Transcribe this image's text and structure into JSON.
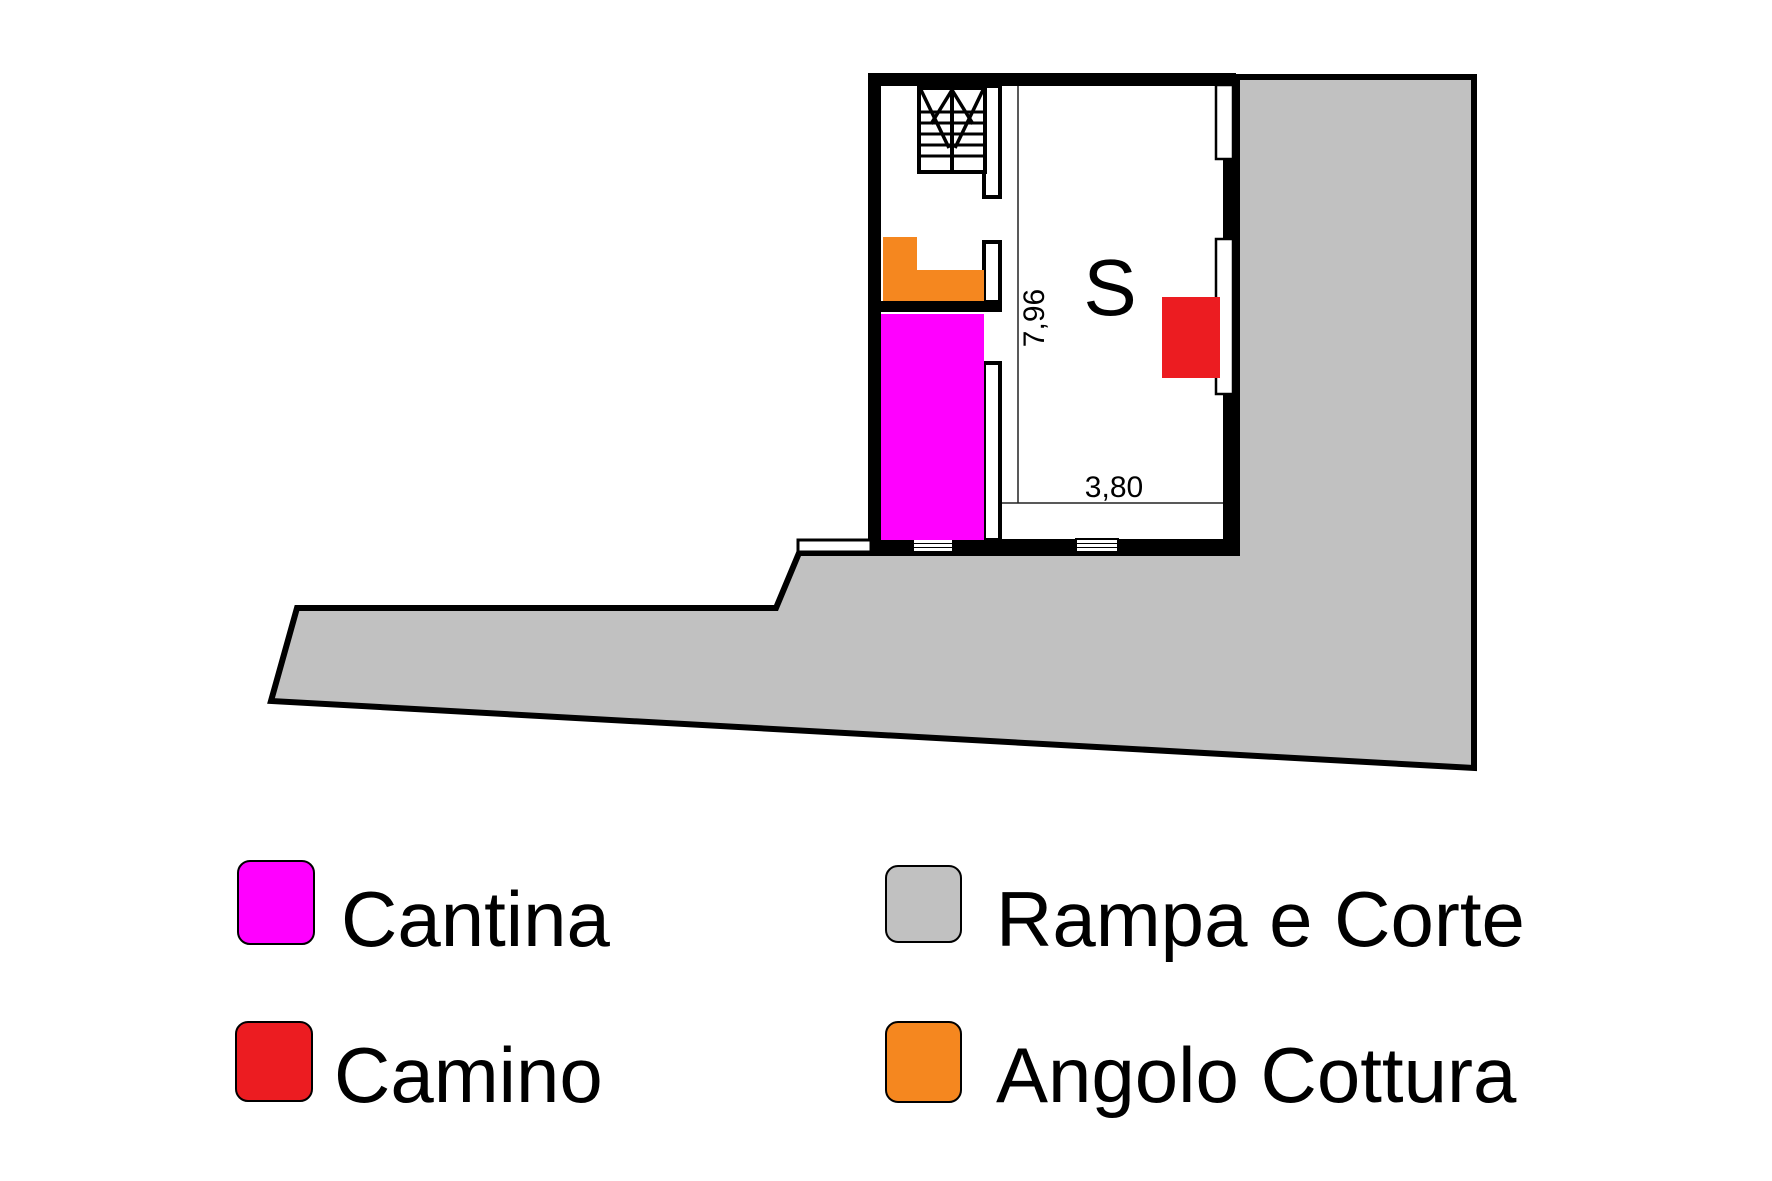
{
  "plan": {
    "room_label": "S",
    "dim_vertical": "7,96",
    "dim_horizontal": "3,80",
    "colors": {
      "cantina": "#FF00FF",
      "camino": "#EC1C21",
      "rampa_corte": "#C1C1C1",
      "angolo_cottura": "#F5871F",
      "wall": "#000000"
    }
  },
  "legend": {
    "items": [
      {
        "label": "Cantina",
        "color": "#FF00FF"
      },
      {
        "label": "Rampa e Corte",
        "color": "#C1C1C1"
      },
      {
        "label": "Camino",
        "color": "#EC1C21"
      },
      {
        "label": "Angolo Cottura",
        "color": "#F5871F"
      }
    ]
  }
}
